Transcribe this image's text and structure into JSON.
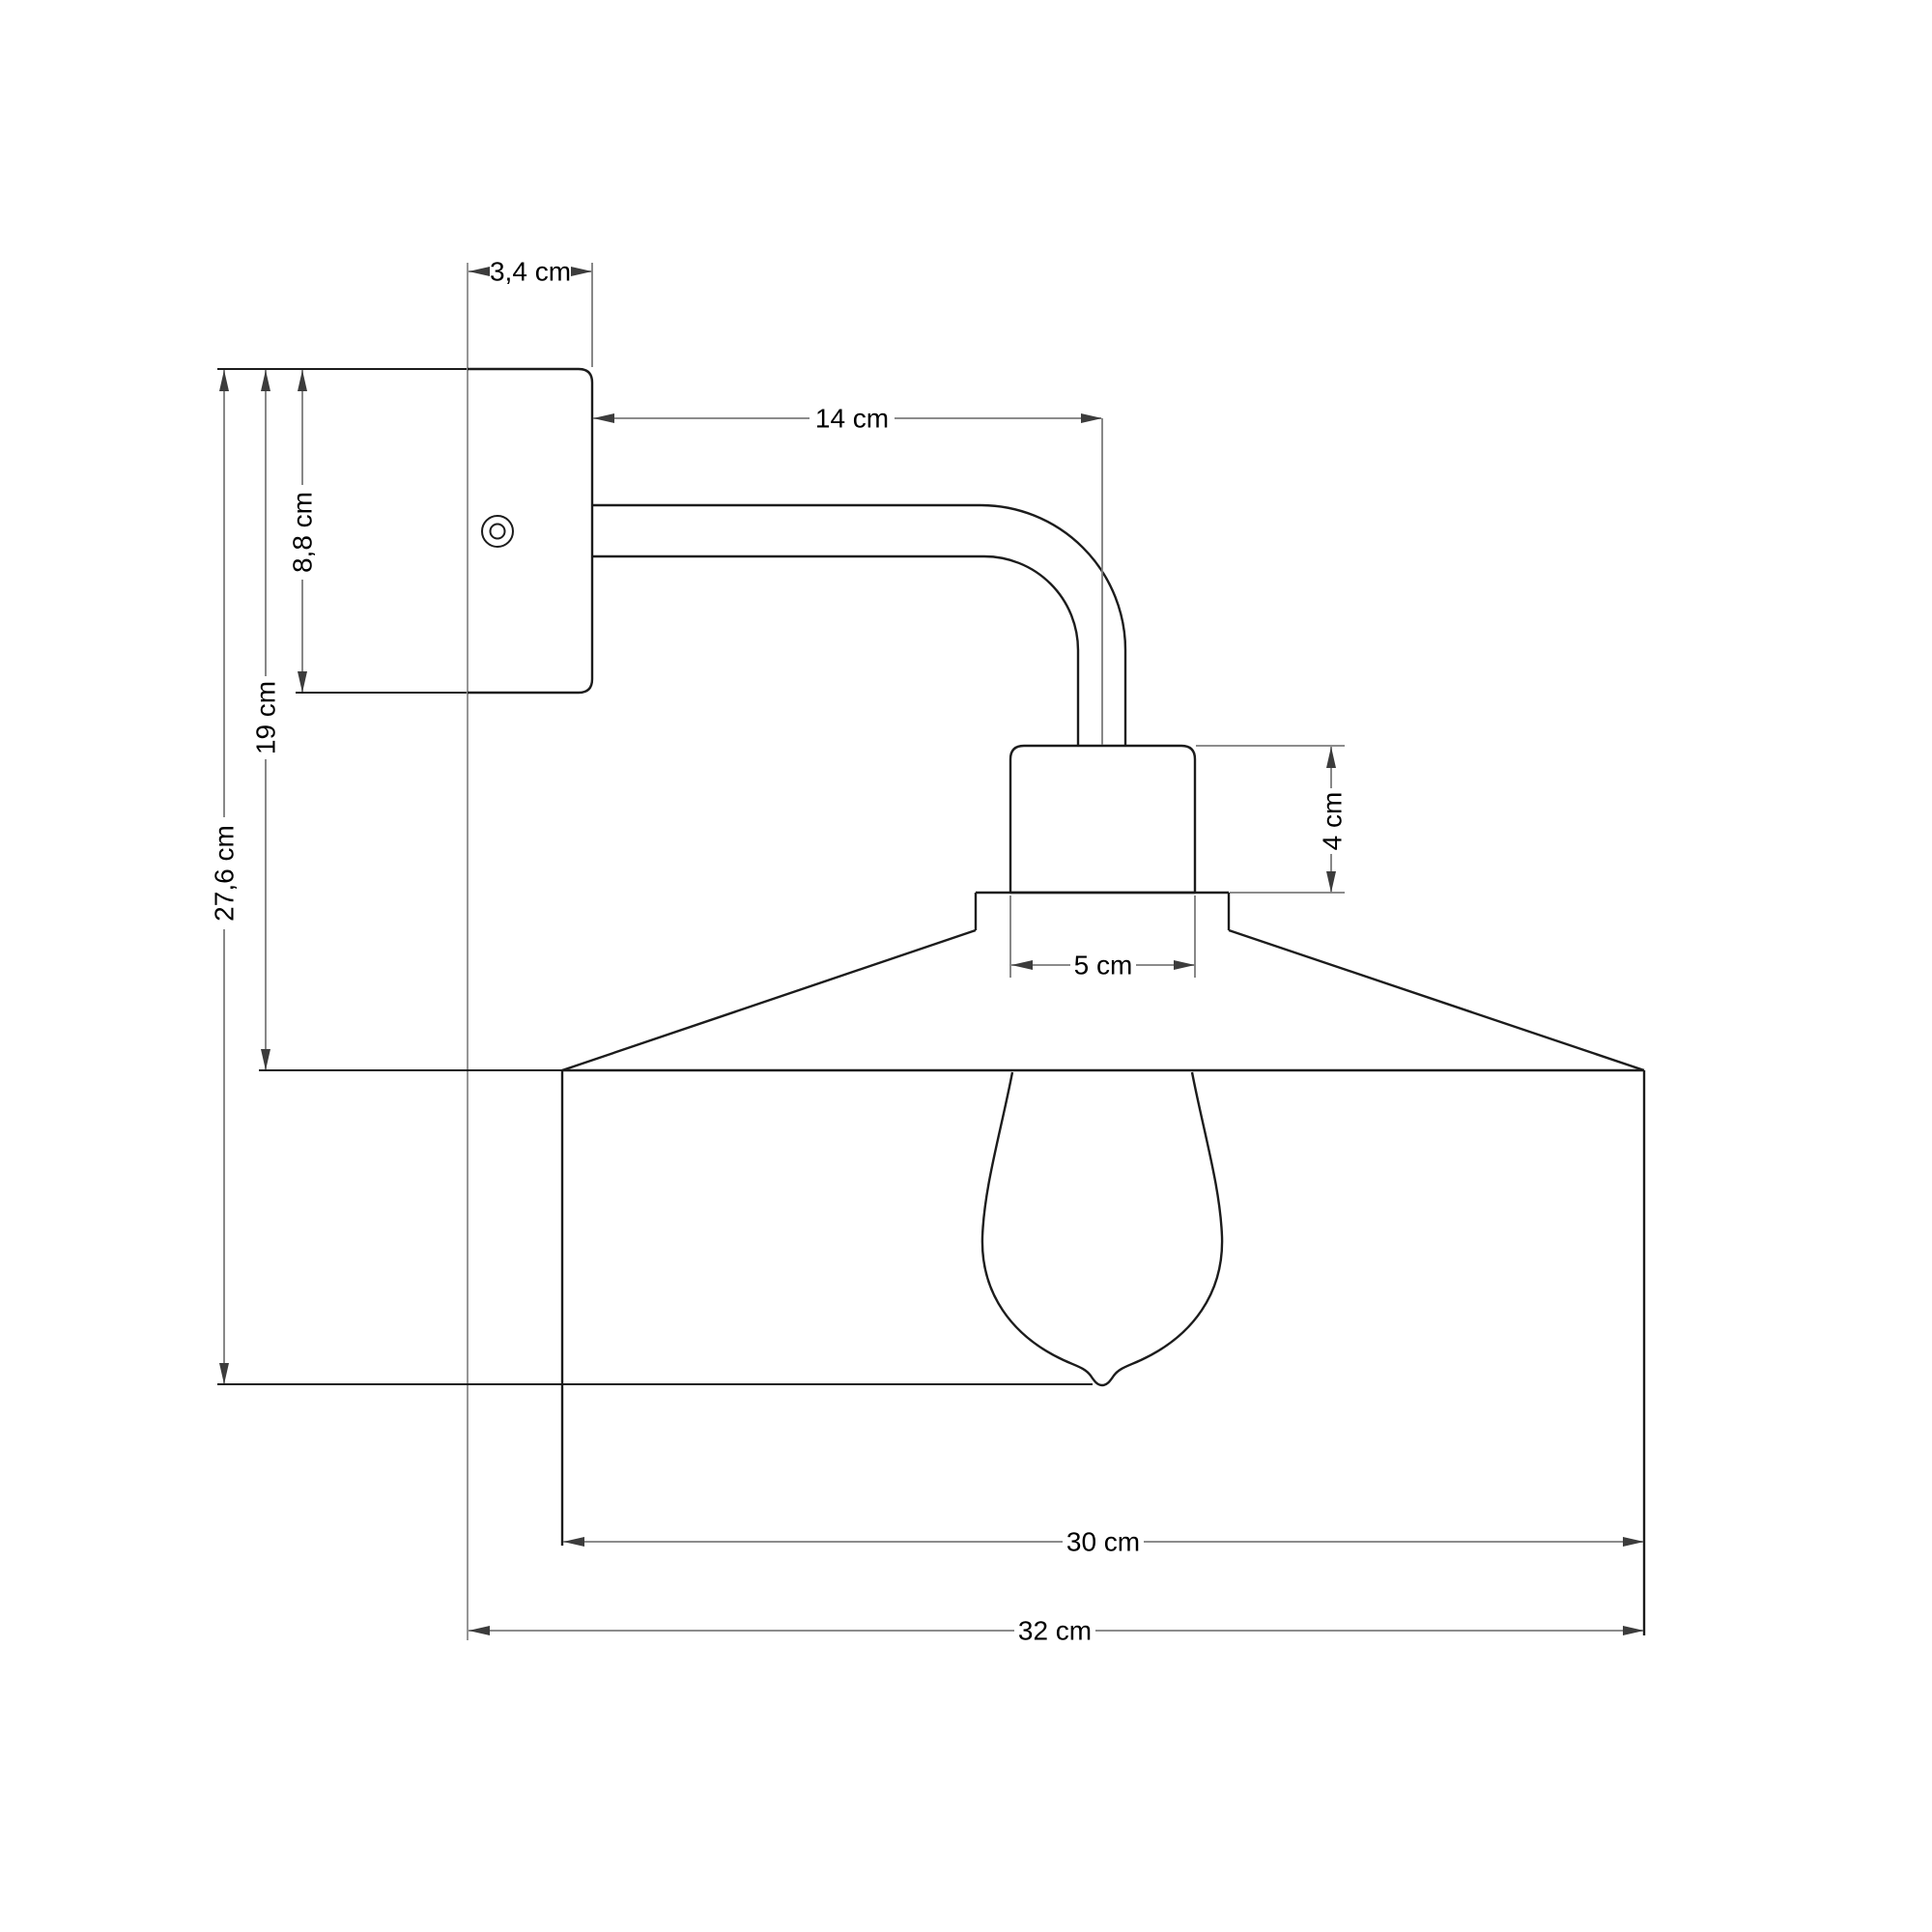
{
  "drawing": {
    "title": "Wall lamp technical dimension drawing (side view)",
    "units": "cm",
    "dimensions": {
      "plate_depth": "3,4 cm",
      "arm_length": "14 cm",
      "plate_height": "8,8 cm",
      "mount_top_to_shade_top": "19 cm",
      "total_height": "27,6 cm",
      "socket_height": "4 cm",
      "socket_width": "5 cm",
      "shade_diameter": "30 cm",
      "total_depth": "32 cm"
    },
    "colors": {
      "background": "#ffffff",
      "part_outline": "#1c1c1c",
      "dimension_lines": "#7b7b7b",
      "wall_line": "#8a8a8a",
      "text": "#000000"
    },
    "parts": {
      "wall_plate": "wall mount plate with screw hole",
      "arm": "curved tube arm",
      "socket": "lamp holder",
      "shade": "conical-top drum lampshade",
      "bulb": "edison bulb"
    }
  }
}
